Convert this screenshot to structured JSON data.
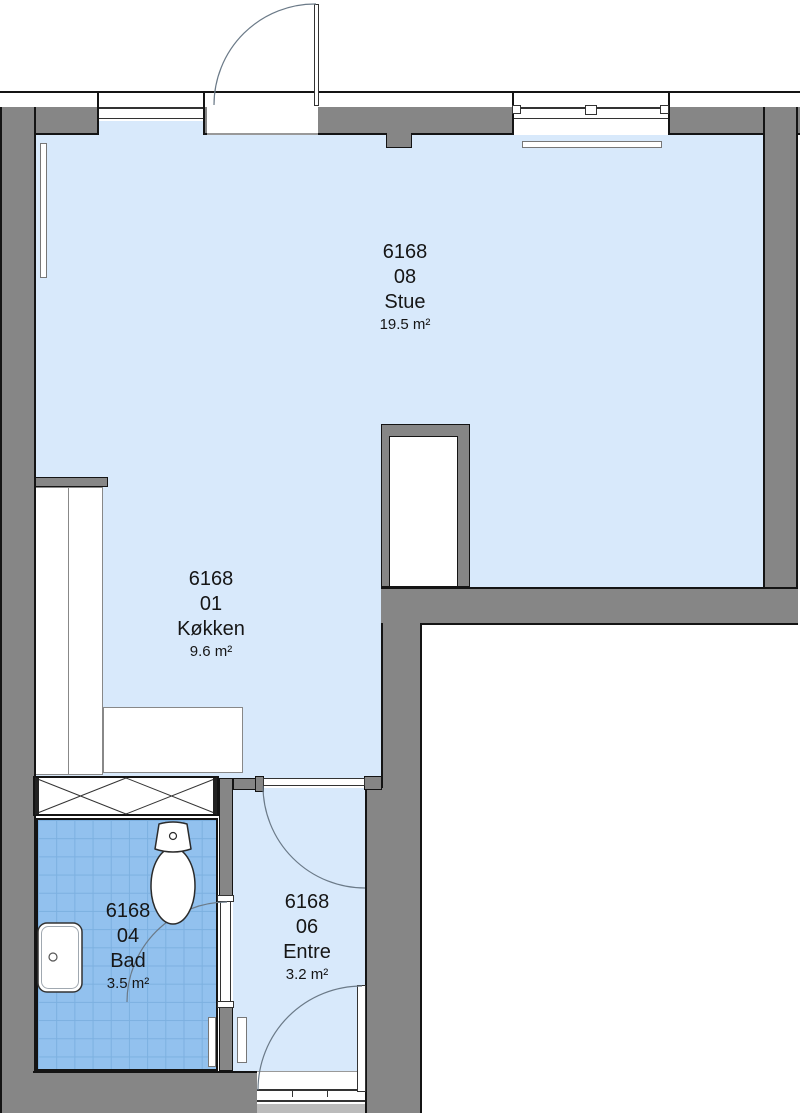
{
  "plan": {
    "title": "Apartment floor plan 6168",
    "rooms": [
      {
        "key": "stue",
        "unit": "6168",
        "number": "08",
        "name": "Stue",
        "area": "19.5 m²"
      },
      {
        "key": "kokken",
        "unit": "6168",
        "number": "01",
        "name": "Køkken",
        "area": "9.6 m²"
      },
      {
        "key": "bad",
        "unit": "6168",
        "number": "04",
        "name": "Bad",
        "area": "3.5 m²"
      },
      {
        "key": "entre",
        "unit": "6168",
        "number": "06",
        "name": "Entre",
        "area": "3.2 m²"
      }
    ],
    "fixtures": [
      "toilet",
      "sink",
      "radiator",
      "kitchen-counter",
      "ventilation-hatch",
      "shaft",
      "door-swing",
      "window"
    ],
    "colors": {
      "wall": "#868686",
      "outline": "#141414",
      "floor": "#d8e9fb",
      "tile": "#92c1ee",
      "tile_line": "#7cb0e0",
      "arc": "#6b7a88"
    }
  }
}
